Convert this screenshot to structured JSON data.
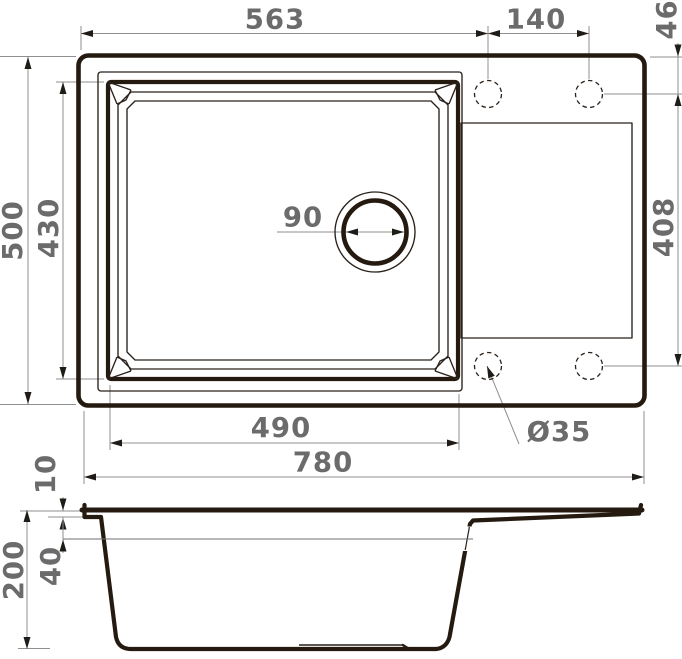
{
  "drawing": {
    "type": "technical-drawing",
    "subject": "kitchen sink with bowl and drainboard, top view and section view",
    "units": "mm",
    "colors": {
      "background": "#ffffff",
      "object_line": "#241a10",
      "dimension_line": "#8f8f8f",
      "dimension_text": "#6b6b6b",
      "arrow": "#1f1c18"
    },
    "labels": {
      "width_to_tap_hole": "563",
      "tap_hole_spacing": "140",
      "tap_hole_edge_offset": "46",
      "overall_front_to_back": "500",
      "bowl_front_to_back": "430",
      "drain_opening": "90",
      "tap_hole_span_vertical": "408",
      "bowl_width": "490",
      "tap_hole_diameter": "Ø35",
      "overall_width": "780",
      "rim_height": "10",
      "drainboard_depth": "40",
      "overall_height": "200"
    }
  }
}
